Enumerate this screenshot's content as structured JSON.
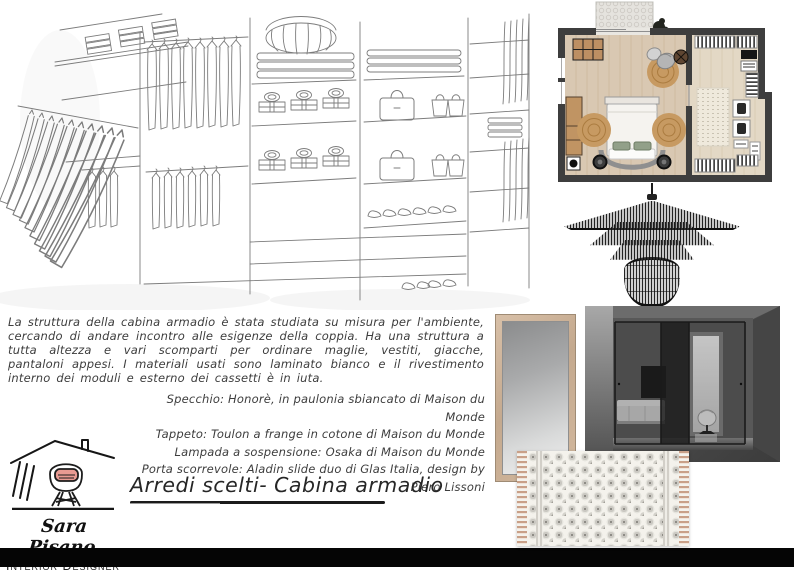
{
  "header": {
    "title": "Arredi scelti- Cabina armadio"
  },
  "description": "La struttura della cabina armadio è stata studiata su misura per l'ambiente, cercando di andare incontro alle esigenze della coppia. Ha una struttura a tutta altezza e vari scomparti per ordinare maglie, vestiti, giacche, pantaloni appesi. I materiali usati sono laminato bianco e il rivestimento interno dei moduli e esterno dei cassetti è in iuta.",
  "furnishings": [
    "Specchio: Honorè, in paulonia sbiancato di Maison du Monde",
    "Tappeto: Toulon a frange in cotone di Maison du Monde",
    "Lampada a sospensione: Osaka di Maison du Monde",
    "Porta scorrevole: Aladin slide duo di Glas Italia, design by Piero Lissoni"
  ],
  "logo": {
    "name": "Sara Pisano",
    "subtitle": "Interior Designer"
  },
  "images": {
    "closet_sketch": "walk-in-closet-sketch",
    "floor_plan": "bedroom-floor-plan",
    "pendant_lamp": "black-wire-pendant-lamp",
    "mirror": "honore-mirror",
    "sliding_door": "aladin-sliding-glass-door",
    "rug": "toulon-fringed-rug"
  },
  "colors": {
    "accent_pink": "#e89a92",
    "plan_wall": "#3e3e3e",
    "wood_floor": "#d9c8b2",
    "jute": "#c79a62",
    "mirror_frame": "#c9ae94",
    "fringe": "#c9a088",
    "bottom_bar": "#050505"
  }
}
